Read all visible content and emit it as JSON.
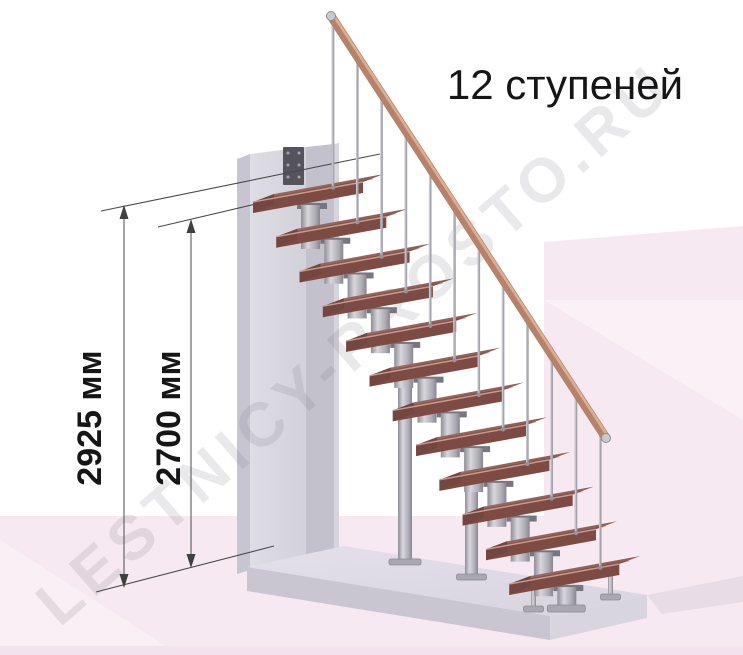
{
  "title": "12 ступеней",
  "dimensions": [
    {
      "label": "2925 мм"
    },
    {
      "label": "2700 мм"
    }
  ],
  "watermark": "LESTNICY-PROSTO.RU",
  "staircase": {
    "step_count": 12,
    "baluster_count": 12
  },
  "colors": {
    "wood_top": "#9a6a61",
    "wood_top_light": "#a87770",
    "wood_front": "#7d4b44",
    "wood_end": "#744640",
    "wood_edge_highlight": "#c79e8f",
    "handrail": "#b5836c",
    "handrail_highlight": "#ddae92",
    "metal": "#b7b4bc",
    "metal_light": "#d8d6dc",
    "metal_dark": "#8e8c94",
    "wall_front": "#dadae2",
    "wall_side": "#c7c6d0",
    "wall_shade": "#c2c1cc",
    "platform_top": "#e0dce6",
    "platform_front": "#c9c6d1",
    "platform_side": "#d8d5df",
    "background_pink": "#f6e9f1",
    "background_pink_deep": "#f3e3ee",
    "dimension_line": "#4a4a4a",
    "text": "#161616",
    "watermark_gray": "rgba(120,115,125,0.16)"
  }
}
